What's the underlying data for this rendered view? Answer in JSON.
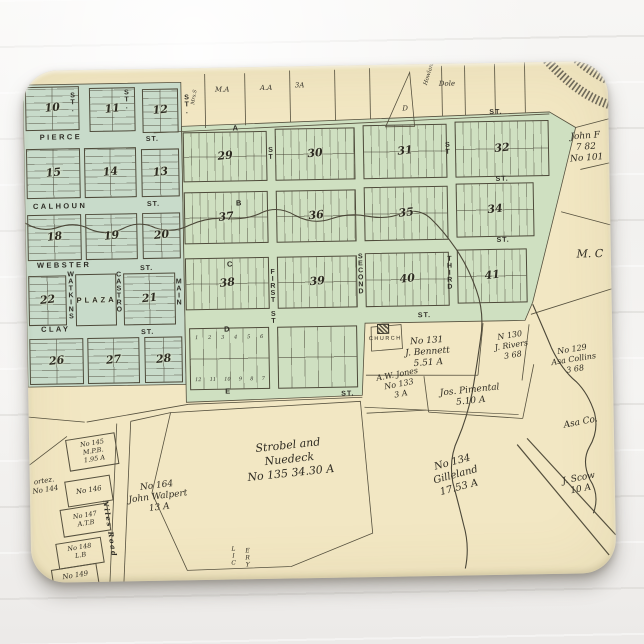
{
  "product": {
    "type": "mousepad product photo",
    "background_color": "#f3f2f0",
    "pad_color": "#f2e7c3"
  },
  "map": {
    "palette": {
      "paper": "#f2e7c3",
      "green_west": "#c8dbca",
      "green_central": "#cfe0c1",
      "ink": "#2f2c23",
      "line": "#55503e",
      "creek": "#4b4738",
      "track": "#6f6a5a"
    },
    "lettered_streets": [
      "A",
      "B",
      "C",
      "D",
      "E"
    ],
    "named_streets": [
      "PIERCE",
      "CALHOUN",
      "WEBSTER",
      "CLAY",
      "WATKINS",
      "CASTRO",
      "MAIN",
      "FIRST ST",
      "SECOND",
      "THIRD",
      "Niles Road"
    ],
    "street_labels": {
      "horizontal": [
        {
          "t": "PIERCE",
          "x": 16,
          "y": 62
        },
        {
          "t": "ST.",
          "x": 122,
          "y": 67,
          "cls": "st"
        },
        {
          "t": "CALHOUN",
          "x": 8,
          "y": 131
        },
        {
          "t": "ST.",
          "x": 122,
          "y": 132,
          "cls": "st"
        },
        {
          "t": "WEBSTER",
          "x": 11,
          "y": 190
        },
        {
          "t": "ST.",
          "x": 114,
          "y": 196,
          "cls": "st"
        },
        {
          "t": "CLAY",
          "x": 14,
          "y": 254
        },
        {
          "t": "ST.",
          "x": 114,
          "y": 260,
          "cls": "st"
        },
        {
          "t": "A",
          "x": 209,
          "y": 56
        },
        {
          "t": "ST.",
          "x": 466,
          "y": 46,
          "cls": "st"
        },
        {
          "t": "B",
          "x": 211,
          "y": 131
        },
        {
          "t": "ST.",
          "x": 471,
          "y": 113,
          "cls": "st"
        },
        {
          "t": "C",
          "x": 201,
          "y": 192
        },
        {
          "t": "ST.",
          "x": 471,
          "y": 174,
          "cls": "st"
        },
        {
          "t": "D",
          "x": 197,
          "y": 257
        },
        {
          "t": "ST.",
          "x": 391,
          "y": 248,
          "cls": "st"
        },
        {
          "t": "E",
          "x": 197,
          "y": 319
        },
        {
          "t": "ST.",
          "x": 313,
          "y": 325,
          "cls": "st"
        }
      ],
      "vertical": [
        {
          "t": "ST.",
          "x": 45,
          "y": 22
        },
        {
          "t": "ST.",
          "x": 99,
          "y": 20
        },
        {
          "t": "ST.",
          "x": 159,
          "y": 26
        },
        {
          "t": "WATKINS",
          "x": 40,
          "y": 201
        },
        {
          "t": "CASTRO",
          "x": 88,
          "y": 202
        },
        {
          "t": "MAIN",
          "x": 148,
          "y": 210
        },
        {
          "t": "FIRST ST",
          "x": 242,
          "y": 202
        },
        {
          "t": "SECOND",
          "x": 330,
          "y": 188
        },
        {
          "t": "THIRD",
          "x": 419,
          "y": 192
        },
        {
          "t": "ST",
          "x": 242,
          "y": 80
        },
        {
          "t": "ST",
          "x": 419,
          "y": 78
        }
      ],
      "roads": [
        {
          "t": "Niles Road",
          "x": 80,
          "y": 430,
          "rot": 82
        }
      ]
    },
    "blocks": [
      {
        "num": "10",
        "x": 2,
        "y": 16,
        "w": 54,
        "h": 44,
        "dir": "h"
      },
      {
        "num": "11",
        "x": 66,
        "y": 18,
        "w": 46,
        "h": 44,
        "dir": "h"
      },
      {
        "num": "12",
        "x": 119,
        "y": 20,
        "w": 36,
        "h": 44,
        "dir": "h"
      },
      {
        "num": "15",
        "x": 2,
        "y": 78,
        "w": 54,
        "h": 50,
        "dir": "h"
      },
      {
        "num": "14",
        "x": 60,
        "y": 78,
        "w": 52,
        "h": 50,
        "dir": "h"
      },
      {
        "num": "13",
        "x": 117,
        "y": 80,
        "w": 38,
        "h": 48,
        "dir": "h"
      },
      {
        "num": "18",
        "x": 2,
        "y": 144,
        "w": 54,
        "h": 46,
        "dir": "h"
      },
      {
        "num": "19",
        "x": 60,
        "y": 144,
        "w": 52,
        "h": 46,
        "dir": "h"
      },
      {
        "num": "20",
        "x": 117,
        "y": 144,
        "w": 38,
        "h": 46,
        "dir": "h"
      },
      {
        "num": "22",
        "x": 2,
        "y": 205,
        "w": 38,
        "h": 50,
        "dir": "h"
      },
      {
        "num": "PLAZA",
        "x": 49,
        "y": 204,
        "w": 41,
        "h": 52,
        "dir": "plaza"
      },
      {
        "num": "21",
        "x": 97,
        "y": 204,
        "w": 52,
        "h": 52,
        "dir": "h"
      },
      {
        "num": "26",
        "x": 2,
        "y": 268,
        "w": 54,
        "h": 46,
        "dir": "h"
      },
      {
        "num": "27",
        "x": 60,
        "y": 268,
        "w": 52,
        "h": 46,
        "dir": "h"
      },
      {
        "num": "28",
        "x": 117,
        "y": 268,
        "w": 38,
        "h": 46,
        "dir": "h"
      },
      {
        "num": "29",
        "x": 159,
        "y": 64,
        "w": 84,
        "h": 50,
        "dir": "v"
      },
      {
        "num": "30",
        "x": 251,
        "y": 62,
        "w": 80,
        "h": 52,
        "dir": "v"
      },
      {
        "num": "31",
        "x": 339,
        "y": 60,
        "w": 84,
        "h": 54,
        "dir": "v"
      },
      {
        "num": "32",
        "x": 431,
        "y": 58,
        "w": 94,
        "h": 56,
        "dir": "v"
      },
      {
        "num": "37",
        "x": 159,
        "y": 124,
        "w": 84,
        "h": 52,
        "dir": "v"
      },
      {
        "num": "36",
        "x": 251,
        "y": 124,
        "w": 80,
        "h": 52,
        "dir": "v"
      },
      {
        "num": "35",
        "x": 339,
        "y": 122,
        "w": 84,
        "h": 54,
        "dir": "v"
      },
      {
        "num": "34",
        "x": 431,
        "y": 120,
        "w": 78,
        "h": 54,
        "dir": "v"
      },
      {
        "num": "38",
        "x": 159,
        "y": 190,
        "w": 84,
        "h": 52,
        "dir": "v"
      },
      {
        "num": "39",
        "x": 251,
        "y": 190,
        "w": 80,
        "h": 52,
        "dir": "v"
      },
      {
        "num": "40",
        "x": 339,
        "y": 188,
        "w": 84,
        "h": 54,
        "dir": "v"
      },
      {
        "num": "41",
        "x": 431,
        "y": 186,
        "w": 70,
        "h": 54,
        "dir": "v"
      },
      {
        "num": "",
        "x": 162,
        "y": 260,
        "w": 80,
        "h": 62,
        "dir": "lots"
      },
      {
        "num": "",
        "x": 250,
        "y": 260,
        "w": 80,
        "h": 62,
        "dir": "lots2"
      }
    ],
    "lot_numbers": {
      "top": [
        "1",
        "2",
        "3",
        "4",
        "5",
        "6"
      ],
      "bottom": [
        "12",
        "11",
        "10",
        "9",
        "8",
        "7"
      ]
    },
    "top_strip_labels": [
      {
        "t": "M.A",
        "x": 192,
        "y": 18
      },
      {
        "t": "A.A",
        "x": 237,
        "y": 17
      },
      {
        "t": "3A",
        "x": 272,
        "y": 15
      },
      {
        "t": "D",
        "x": 379,
        "y": 40
      },
      {
        "t": "Dole",
        "x": 416,
        "y": 16
      },
      {
        "t": "Howland",
        "x": 400,
        "y": 20,
        "rot": -72,
        "fs": 5.5
      },
      {
        "t": "Mrs.S",
        "x": 167,
        "y": 36,
        "rot": -80,
        "fs": 5
      }
    ],
    "parcels": [
      {
        "id": "church",
        "lines": [
          "CHURCH"
        ],
        "x": 358,
        "y": 271,
        "fs": 5.5,
        "cls": "caps"
      },
      {
        "id": "bennett",
        "lines": [
          "No 131",
          "J. Bennett",
          "5.51 A"
        ],
        "x": 400,
        "y": 272,
        "fs": 9,
        "rot": -3
      },
      {
        "id": "rivers",
        "lines": [
          "N 130",
          "J. Rivers",
          "3 68"
        ],
        "x": 484,
        "y": 268,
        "fs": 8,
        "rot": -8
      },
      {
        "id": "collins",
        "lines": [
          "No 129",
          "Asa Collins",
          "3 68"
        ],
        "x": 546,
        "y": 283,
        "fs": 8,
        "rot": -8
      },
      {
        "id": "jones",
        "lines": [
          "A.W. Jones",
          "No 133",
          "3 A"
        ],
        "x": 371,
        "y": 305,
        "fs": 8,
        "rot": -10
      },
      {
        "id": "pimental",
        "lines": [
          "Jos. Pimental",
          "5.10 A"
        ],
        "x": 442,
        "y": 322,
        "fs": 9,
        "rot": -5
      },
      {
        "id": "asa-co",
        "lines": [
          "Asa Co."
        ],
        "x": 552,
        "y": 356,
        "fs": 9,
        "rot": -10
      },
      {
        "id": "strobel",
        "lines": [
          "Strobel and",
          "Nuedeck",
          "No 135    34.30 A"
        ],
        "x": 260,
        "y": 372,
        "fs": 11,
        "rot": -5
      },
      {
        "id": "walpert",
        "lines": [
          "No 164",
          "John Walpert",
          "13 A"
        ],
        "x": 128,
        "y": 412,
        "fs": 9,
        "rot": -6
      },
      {
        "id": "gilleland",
        "lines": [
          "No 134",
          "Gilleland",
          "17.53 A"
        ],
        "x": 426,
        "y": 392,
        "fs": 10,
        "rot": -14
      },
      {
        "id": "scow",
        "lines": [
          "J. Scow",
          "10 A"
        ],
        "x": 550,
        "y": 412,
        "fs": 9,
        "rot": -10
      },
      {
        "id": "john-f",
        "lines": [
          "John F",
          "7 82",
          "No 101"
        ],
        "x": 562,
        "y": 70,
        "fs": 9,
        "rot": -3
      },
      {
        "id": "m-c",
        "lines": [
          "M. C"
        ],
        "x": 564,
        "y": 186,
        "fs": 11,
        "rot": 0
      },
      {
        "id": "cortez",
        "lines": [
          "ortez.",
          "No 144"
        ],
        "x": 15,
        "y": 406,
        "fs": 7,
        "rot": -8
      },
      {
        "id": "p145",
        "lines": [
          "No 145",
          "M.P.B.",
          "1.95 A"
        ],
        "x": 64,
        "y": 369,
        "fs": 6.5,
        "rot": -8,
        "box": [
          38,
          366,
          50,
          32
        ]
      },
      {
        "id": "p146",
        "lines": [
          "No 146"
        ],
        "x": 59,
        "y": 416,
        "fs": 7,
        "rot": -8,
        "box": [
          36,
          408,
          46,
          26
        ]
      },
      {
        "id": "p147",
        "lines": [
          "No 147",
          "A.T.B"
        ],
        "x": 55,
        "y": 441,
        "fs": 6.5,
        "rot": -8,
        "box": [
          31,
          436,
          48,
          28
        ]
      },
      {
        "id": "p148",
        "lines": [
          "No 148",
          "L.B"
        ],
        "x": 49,
        "y": 473,
        "fs": 6.5,
        "rot": -8,
        "box": [
          26,
          470,
          46,
          26
        ]
      },
      {
        "id": "p149",
        "lines": [
          "No 149"
        ],
        "x": 44,
        "y": 501,
        "fs": 7,
        "rot": -8,
        "box": [
          21,
          496,
          46,
          24
        ]
      },
      {
        "id": "cemetery-frag-1",
        "lines": [
          "LIC"
        ],
        "x": 202,
        "y": 478,
        "fs": 6,
        "vert": 1
      },
      {
        "id": "cemetery-frag-2",
        "lines": [
          "ERY"
        ],
        "x": 216,
        "y": 480,
        "fs": 6,
        "vert": 1
      }
    ],
    "church_icon": {
      "x": 350,
      "y": 259,
      "w": 10,
      "h": 8
    },
    "svg": {
      "polys": [
        {
          "pts": "0,14 158,14 158,316 0,316",
          "fill": "green_west"
        },
        {
          "pts": "158,58 526,50 552,66 532,142 506,240 498,258 338,258 334,330 158,334",
          "fill": "green_central"
        }
      ],
      "lines": [
        {
          "d": "M130,64 L526,52"
        },
        {
          "d": "M182,6 L182,60"
        },
        {
          "d": "M222,6 L222,58"
        },
        {
          "d": "M267,4 L267,56"
        },
        {
          "d": "M312,4 L312,55"
        },
        {
          "d": "M347,3 L347,54"
        },
        {
          "d": "M419,2 L419,52"
        },
        {
          "d": "M442,2 L442,52"
        },
        {
          "d": "M472,1 L472,51"
        },
        {
          "d": "M502,0 L502,50"
        },
        {
          "d": "M362,62 L387,8 L391,62 Z"
        },
        {
          "d": "M552,66 L585,58"
        },
        {
          "d": "M556,108 L585,102"
        },
        {
          "d": "M536,150 L585,164"
        },
        {
          "d": "M504,252 L585,228"
        },
        {
          "d": "M344,262 L374,260 L375,284 L344,286 Z"
        },
        {
          "d": "M456,260 L450,312"
        },
        {
          "d": "M502,262 L494,318"
        },
        {
          "d": "M338,310 L450,312"
        },
        {
          "d": "M396,312 L400,348"
        },
        {
          "d": "M338,348 L398,346"
        },
        {
          "d": "M400,348 L494,356"
        },
        {
          "d": "M494,356 L506,302"
        },
        {
          "d": "M160,336 L334,332"
        },
        {
          "d": "M58,352 L160,336"
        },
        {
          "d": "M0,346 L56,352"
        },
        {
          "d": "M142,344 L332,336 L342,468 L260,500 L156,502 L122,424 Z"
        },
        {
          "d": "M102,352 L142,344"
        },
        {
          "d": "M88,354 L78,520"
        },
        {
          "d": "M102,352 L92,520"
        },
        {
          "d": "M0,394 L38,366"
        },
        {
          "d": "M336,342 L490,352",
          "w": 0.7
        },
        {
          "d": "M488,382 L578,494",
          "w": 1.2
        },
        {
          "d": "M498,376 L585,474",
          "w": 1.2
        }
      ],
      "creeks": [
        {
          "d": "M0,152 Q16,162 32,157 Q50,151 64,159 Q82,167 98,159 Q114,151 130,159 Q148,165 164,157 Q182,149 202,151 Q222,153 238,145 Q254,139 270,149 Q288,159 306,153 Q324,147 342,151 Q362,155 376,149 Q394,143 406,155 Q418,167 430,185 Q442,203 450,227 Q458,251 453,277 Q449,303 444,329 Q438,355 429,375 Q419,395 423,419 Q429,443 433,461 Q439,483 434,505"
        },
        {
          "d": "M506,242 Q516,266 524,286 Q534,308 548,320 Q560,332 566,352 Q570,370 560,386 Q552,400 560,418 Q570,434 563,452"
        }
      ],
      "track": [
        {
          "d": "M519,-8 C546,24 570,42 602,48",
          "w": 9
        },
        {
          "d": "M541,-16 C562,8 586,24 614,28, ",
          "w": 9
        }
      ]
    }
  }
}
